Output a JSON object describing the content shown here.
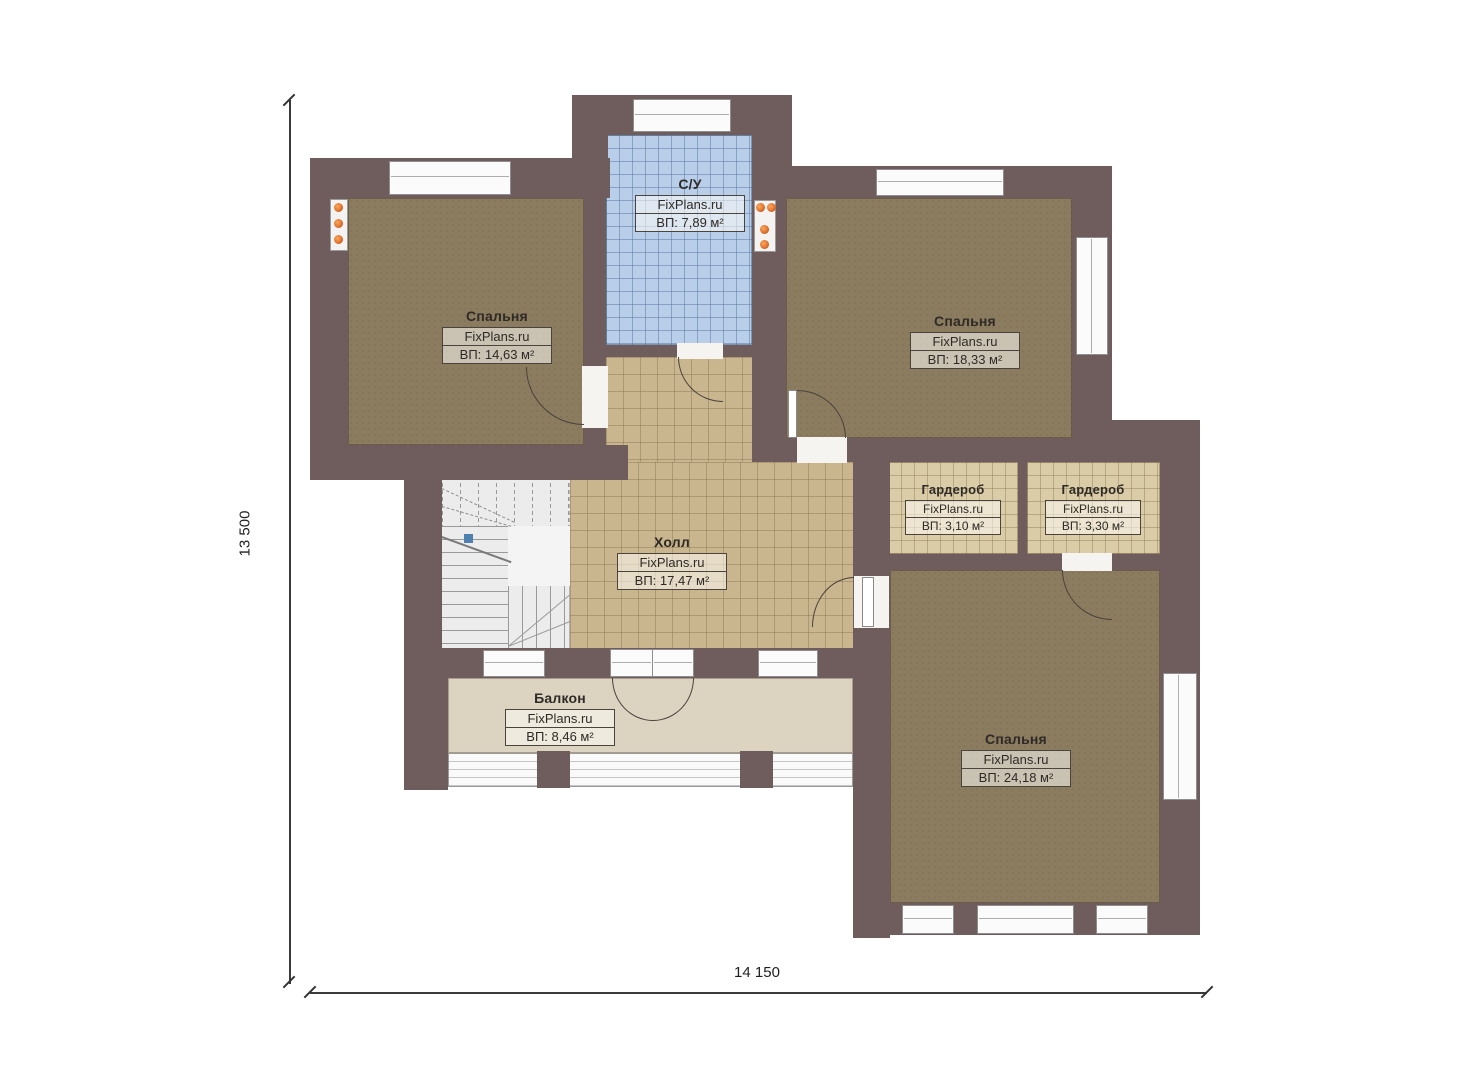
{
  "plan": {
    "brand": "FixPlans.ru",
    "rooms": [
      {
        "key": "bathroom",
        "name": "С/У",
        "area": "ВП: 7,89 м²"
      },
      {
        "key": "bedroom-left",
        "name": "Спальня",
        "area": "ВП: 14,63 м²"
      },
      {
        "key": "bedroom-right",
        "name": "Спальня",
        "area": "ВП: 18,33 м²"
      },
      {
        "key": "wardrobe-left",
        "name": "Гардероб",
        "area": "ВП: 3,10 м²"
      },
      {
        "key": "wardrobe-right",
        "name": "Гардероб",
        "area": "ВП: 3,30 м²"
      },
      {
        "key": "hall",
        "name": "Холл",
        "area": "ВП: 17,47 м²"
      },
      {
        "key": "balcony",
        "name": "Балкон",
        "area": "ВП: 8,46 м²"
      },
      {
        "key": "bedroom-master",
        "name": "Спальня",
        "area": "ВП: 24,18 м²"
      }
    ],
    "dimensions": {
      "vertical": "13 500",
      "horizontal": "14 150"
    },
    "colors": {
      "wall": "#6e5d5c",
      "carpet": "#8b7c5f",
      "tile_blue": "#b9cfe9",
      "tile_tan": "#c9b58e",
      "tile_wardrobe": "#d9cca6",
      "balcony_floor": "#dcd4c1",
      "light_dot": "#e2722f"
    }
  }
}
